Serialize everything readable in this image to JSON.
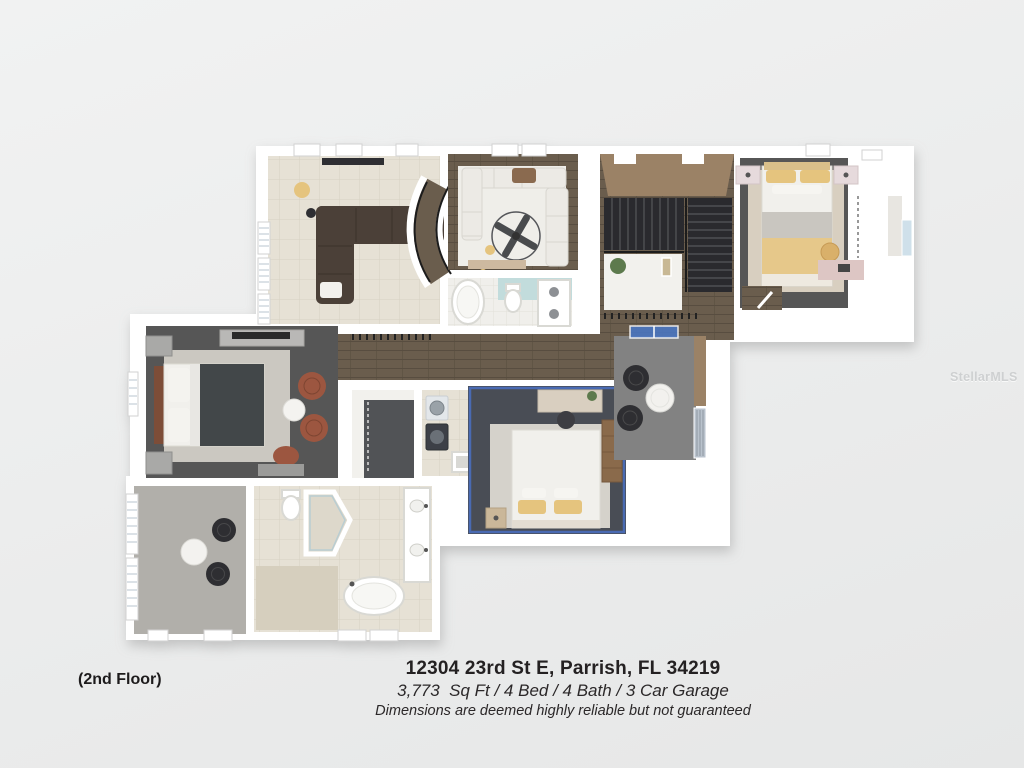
{
  "footer": {
    "address": "12304 23rd St E, Parrish, FL 34219",
    "specs": "3,773  Sq Ft / 4 Bed / 4 Bath / 3 Car Garage",
    "disclaimer": "Dimensions are deemed highly reliable but not guaranteed"
  },
  "floor_label": "(2nd Floor)",
  "watermark": "StellarMLS",
  "floorplan": {
    "view": "3D top-down render",
    "rooms": [
      "bonus-room",
      "media-room",
      "hall-bathroom",
      "stairwell",
      "bedroom-2",
      "closet-2",
      "hallway",
      "master-bedroom",
      "walk-in-closet",
      "laundry",
      "bedroom-3",
      "balcony",
      "master-sitting-room",
      "master-bathroom"
    ]
  },
  "palette": {
    "background_top": "#f1f2f2",
    "background_bottom": "#e6e7e7",
    "wall": "#ffffff",
    "wood_floor": "#6b5d4e",
    "wood_floor_line": "#594e40",
    "tile_beige": "#e6e1d5",
    "tile_line": "#d7d1c2",
    "carpet_dark": "#565656",
    "carpet_light": "#b1afaa",
    "balcony_floor": "#828282",
    "stair_dark": "#2b2b2d",
    "stair_wall_tan": "#9b8266",
    "sofa_brown": "#4b4138",
    "sofa_white": "#eceae5",
    "bed_gold": "#e5c47e",
    "duvet_dark": "#43464a",
    "chair_rust": "#9c5740",
    "accent_blue": "#4a6fbc",
    "bath_teal": "#c2dcdc",
    "text_dark": "#232021"
  }
}
